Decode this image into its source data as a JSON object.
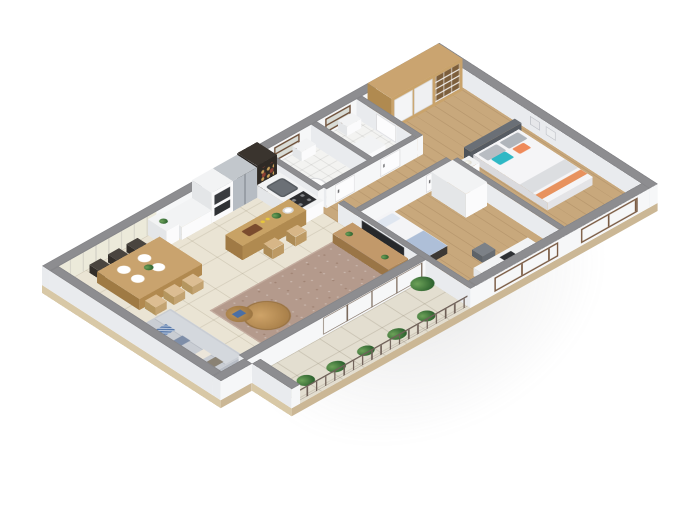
{
  "scene": {
    "type": "isometric-3d-floor-plan",
    "description": "Isometric 3D cutaway rendering of a two-bedroom apartment floor plan on a white background, with gray cut wall tops, white wall faces and a tan floor-slab edge",
    "background": "#ffffff"
  },
  "rooms": [
    {
      "name": "dining-area",
      "floor": "beige-tile",
      "items": [
        "wood-dining-table",
        "six-place-settings",
        "three-dark-chairs",
        "three-light-wood-chairs",
        "white-sideboard",
        "striped-wall-paneling"
      ]
    },
    {
      "name": "kitchen",
      "floor": "beige-tile",
      "items": [
        "white-counter",
        "built-in-oven-tower",
        "stainless-fridge",
        "dark-shelf-unit",
        "sink-counter",
        "dark-hob",
        "wood-breakfast-bar",
        "two-bar-stools",
        "plant",
        "cutting-board"
      ]
    },
    {
      "name": "living-room",
      "floor": "beige-tile",
      "items": [
        "gray-corner-sofa",
        "blue-patterned-pillows",
        "mottled-brown-rug",
        "two-round-wood-coffee-tables",
        "wood-tv-console",
        "wall-mounted-tv",
        "small-plants"
      ]
    },
    {
      "name": "bathroom-1",
      "floor": "white-tile",
      "window": true,
      "items": [
        "toilet",
        "washbasin"
      ]
    },
    {
      "name": "bathroom-2",
      "floor": "white-tile",
      "window": true,
      "items": [
        "washing-machine",
        "washbasin"
      ]
    },
    {
      "name": "bedroom-2",
      "floor": "wood",
      "window": true,
      "items": [
        "single-bed-dark-frame",
        "blue-bedding",
        "desk",
        "chair",
        "laptop",
        "white-wardrobe"
      ]
    },
    {
      "name": "master-bedroom",
      "floor": "wood",
      "window": true,
      "items": [
        "double-bed",
        "gray-headboard",
        "teal-pillow",
        "orange-pillows",
        "white-nightstand",
        "lamp",
        "large-wardrobe-with-open-shelves",
        "wall-art-frames"
      ]
    },
    {
      "name": "balcony",
      "floor": "light-tile",
      "items": [
        "metal-railing",
        "planter-plants",
        "sliding-glass-doors"
      ]
    },
    {
      "name": "hallway",
      "floor": "wood",
      "items": [
        "white-doors"
      ]
    }
  ],
  "palette": {
    "wall_top": "#8d8d90",
    "wall_white": "#f6f7f8",
    "tile_floor": "#eae4d4",
    "wood_floor": "#c8a87c",
    "rug": "#b49a8c",
    "sofa_gray": "#c9cdd3",
    "wood_furniture": "#c9a36e",
    "teal_pillow": "#2fb8c5",
    "orange_pillow": "#ef8a5a",
    "plant_green": "#3f7a3d",
    "window_frame": "#7a5c44",
    "slab_trim": "#cbb795",
    "steel_fridge": "#b9bec4",
    "dark_shelf": "#3a342e"
  }
}
